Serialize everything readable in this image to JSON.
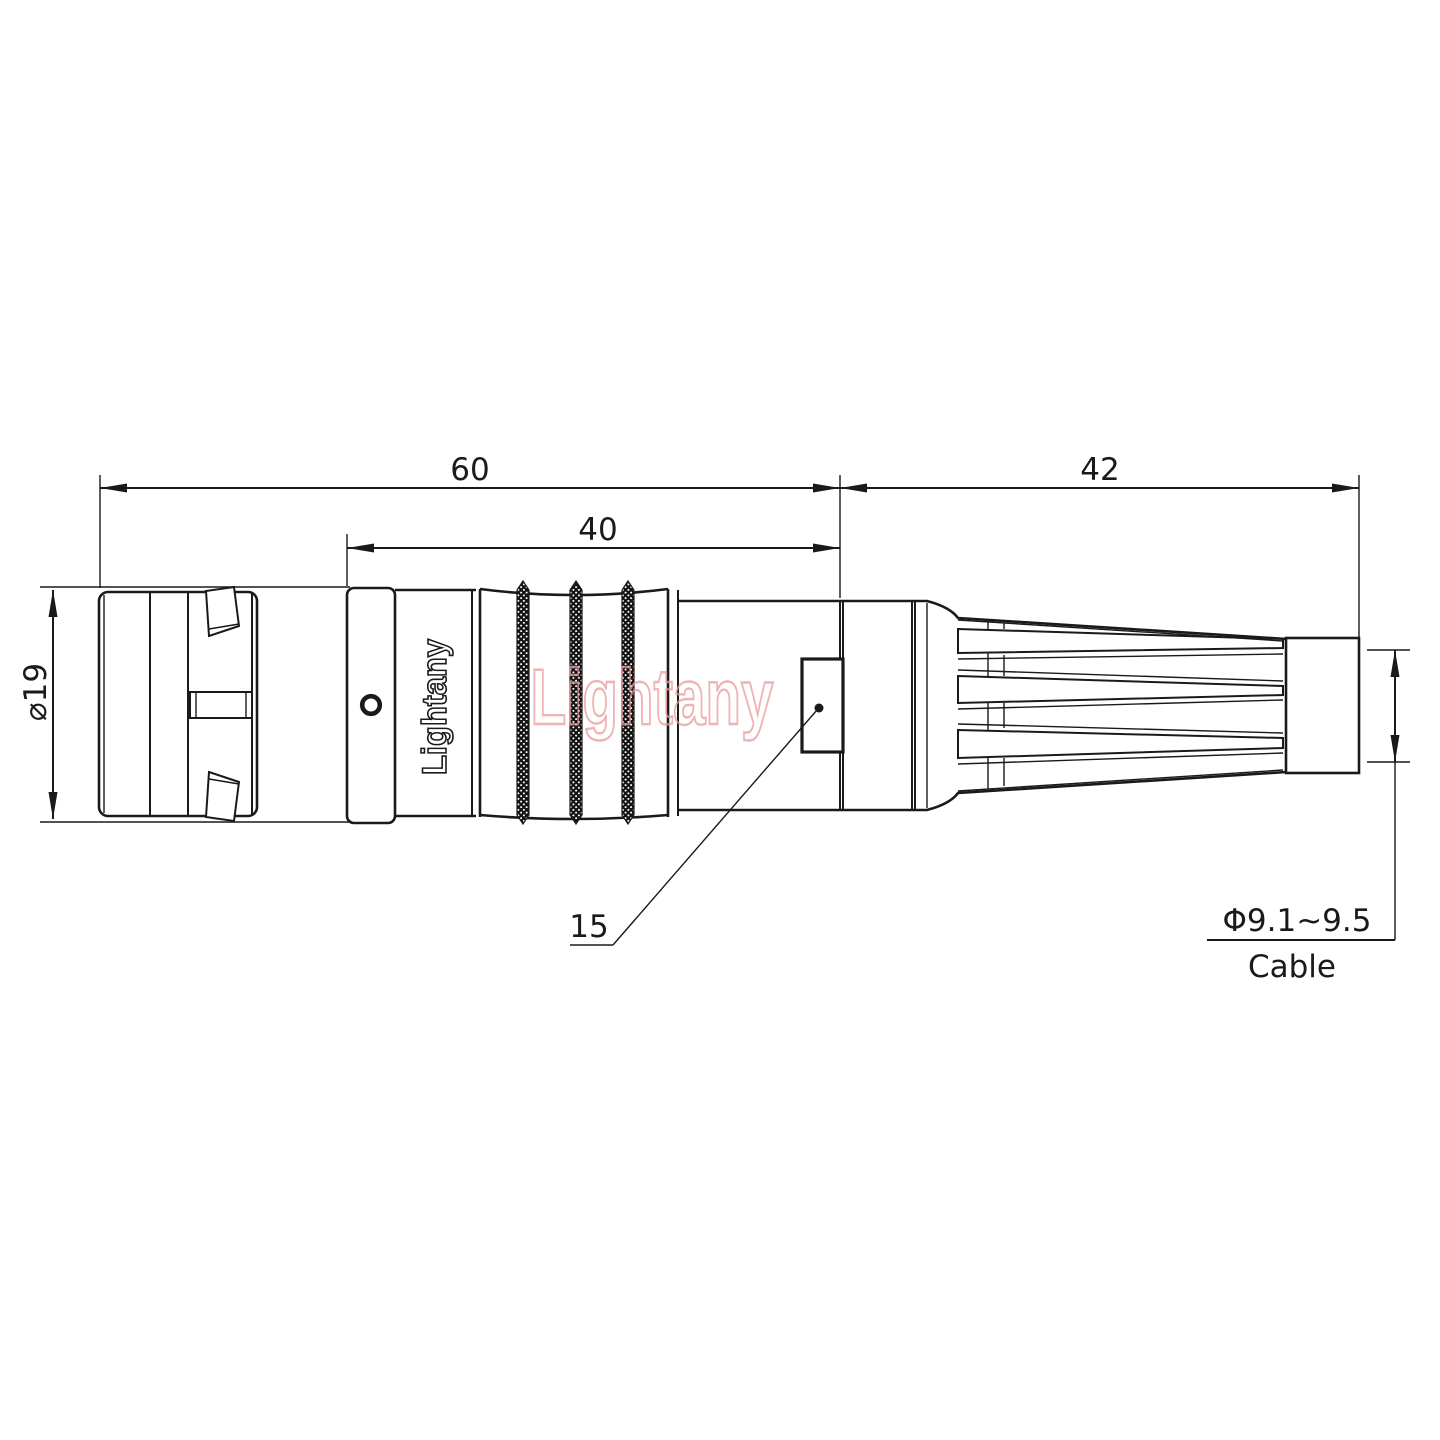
{
  "page": {
    "background": "#ffffff"
  },
  "drawing": {
    "dimensions": {
      "overall_length": "60",
      "body_length": "40",
      "rear_length": "42",
      "shell_diameter": "⌀19",
      "window_size": "15",
      "cable_diameter": "Φ9.1~9.5",
      "cable_label": "Cable"
    },
    "branding": {
      "shell_logo": "Lightany",
      "watermark": "Lightany"
    },
    "colors": {
      "line": "#1a1a1a",
      "watermark_pink": "#e89a9a",
      "background": "#ffffff"
    }
  }
}
